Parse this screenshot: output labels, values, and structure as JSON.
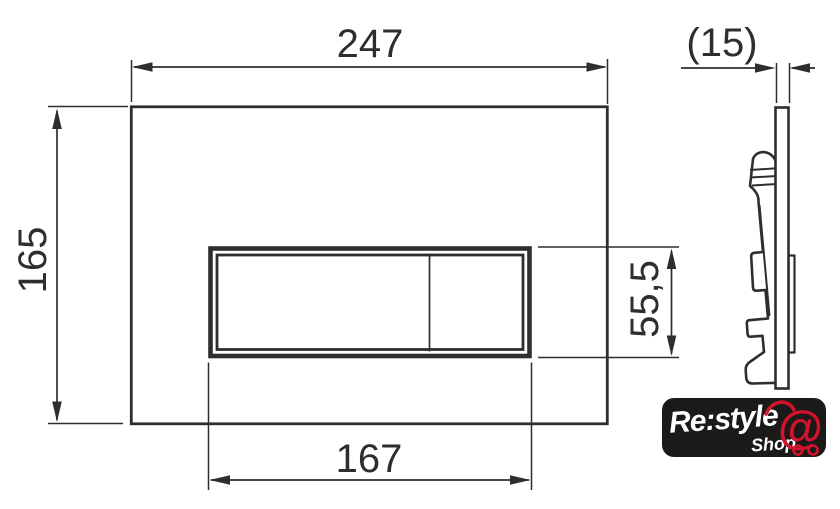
{
  "dimensions": {
    "plate_width": "247",
    "plate_height": "165",
    "button_panel_width": "167",
    "button_panel_height": "55,5",
    "plate_thickness": "(15)"
  },
  "logo": {
    "brand": "Re:style",
    "shop": "Shop",
    "cart_symbol": "@"
  },
  "colors": {
    "line": "#2e2e2e",
    "background": "#ffffff",
    "logo_background": "#1b1a18",
    "logo_text": "#ffffff",
    "logo_accent": "#d4122c"
  }
}
